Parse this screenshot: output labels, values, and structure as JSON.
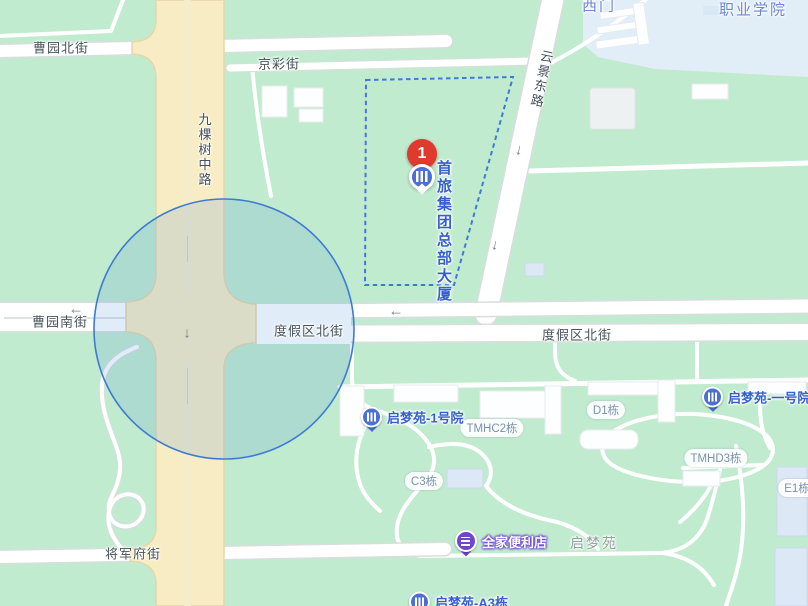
{
  "map": {
    "colors": {
      "land": "#c1ebce",
      "campus": "#e1eef7",
      "road_fill": "#ffffff",
      "road_casing": "#d9dddf",
      "main_road_fill": "#f7ecc3",
      "main_road_casing": "#e6d7a8",
      "circle_fill": "rgba(78,143,217,0.17)",
      "circle_stroke": "#3d7bd3",
      "parcel_stroke": "#3f7ad6",
      "marker_red": "#e03a2f",
      "poi_blue": "#4a70d6",
      "poi_text_blue": "#3560cc",
      "famima_purple": "#6f46d0",
      "street_text": "#46535b",
      "building_text": "#7b91af",
      "campus_text": "#6b86d6",
      "area_text": "#93a1a1",
      "arrow_gray": "#7a838a",
      "building_fill_blue": "#dde8f6"
    },
    "marker": {
      "number": "1",
      "title_line1": "首旅集团",
      "title_line2": "总部大厦"
    },
    "street_labels": [
      {
        "text": "曹园北街",
        "x": 61,
        "y": 47,
        "orientation": "h",
        "rotate": 0
      },
      {
        "text": "京彩街",
        "x": 279,
        "y": 63,
        "orientation": "h",
        "rotate": 0
      },
      {
        "text": "九棵树中路",
        "x": 204,
        "y": 150,
        "orientation": "v",
        "rotate": 0
      },
      {
        "text": "云景东路",
        "x": 541,
        "y": 79,
        "orientation": "v",
        "rotate": 12
      },
      {
        "text": "曹园南街",
        "x": 60,
        "y": 321,
        "orientation": "h",
        "rotate": 0
      },
      {
        "text": "度假区北街",
        "x": 309,
        "y": 330,
        "orientation": "h",
        "rotate": 0
      },
      {
        "text": "度假区北街",
        "x": 577,
        "y": 334,
        "orientation": "h",
        "rotate": 0
      },
      {
        "text": "将军府街",
        "x": 133,
        "y": 553,
        "orientation": "h",
        "rotate": 0
      }
    ],
    "area_labels": [
      {
        "text": "职业学院",
        "x": 753,
        "y": 9,
        "style": "campus"
      },
      {
        "text": "西门",
        "x": 599,
        "y": 5,
        "style": "campus"
      },
      {
        "text": "启梦苑",
        "x": 594,
        "y": 543,
        "style": "area"
      }
    ],
    "building_labels": [
      {
        "text": "TMHC2栋",
        "x": 492,
        "y": 428
      },
      {
        "text": "D1栋",
        "x": 606,
        "y": 410
      },
      {
        "text": "TMHD3栋",
        "x": 716,
        "y": 458
      },
      {
        "text": "C3栋",
        "x": 424,
        "y": 481
      },
      {
        "text": "E1栋",
        "x": 797,
        "y": 488
      }
    ],
    "pois": [
      {
        "type": "residence",
        "text": "启梦苑-1号院",
        "x": 372,
        "y": 417
      },
      {
        "type": "residence",
        "text": "启梦苑-一号院",
        "x": 713,
        "y": 397
      },
      {
        "type": "store",
        "text": "全家便利店",
        "x": 466,
        "y": 541
      },
      {
        "type": "residence",
        "text": "启梦苑-A3栋",
        "x": 420,
        "y": 602
      }
    ],
    "one_way_arrows": [
      {
        "glyph": "←",
        "x": 76,
        "y": 309,
        "rotate": 0
      },
      {
        "glyph": "←",
        "x": 396,
        "y": 311,
        "rotate": 0
      },
      {
        "glyph": "↓",
        "x": 187,
        "y": 333,
        "rotate": 0
      },
      {
        "glyph": "↓",
        "x": 519,
        "y": 150,
        "rotate": 12
      },
      {
        "glyph": "↓",
        "x": 495,
        "y": 245,
        "rotate": 12
      }
    ]
  }
}
